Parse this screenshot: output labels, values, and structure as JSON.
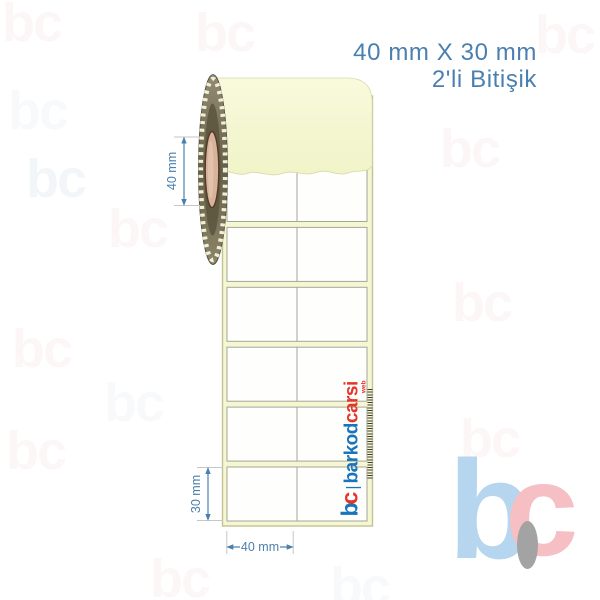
{
  "title": {
    "line1": "40 mm X 30 mm",
    "line2": "2'li Bitişik"
  },
  "dimensions": {
    "core_diameter": "40 mm",
    "label_height": "30 mm",
    "label_width": "40 mm"
  },
  "roll": {
    "rows": 6,
    "columns": 2
  },
  "watermark_logo": {
    "b": "b",
    "c": "c",
    "divider": "|",
    "word1": "barkod",
    "word2": "carsi",
    "suffix": "web"
  },
  "corner_logo": {
    "b": "b",
    "c": "c"
  },
  "background_watermark": {
    "text": "bc"
  },
  "colors": {
    "title_blue": "#4a7fb0",
    "dimension_blue": "#4a80ad",
    "brand_blue": "#1a74bb",
    "brand_red": "#e5342a",
    "liner_cream": "#f5f7d3",
    "strip_border_olive": "#c2c397",
    "cell_border_gray": "#a6a698",
    "core_tan": "#d8b29b",
    "corner_logo_blue": "#b5d6ee",
    "corner_logo_pink": "#f6bfc3",
    "corner_logo_gray": "#a3a3a3"
  }
}
